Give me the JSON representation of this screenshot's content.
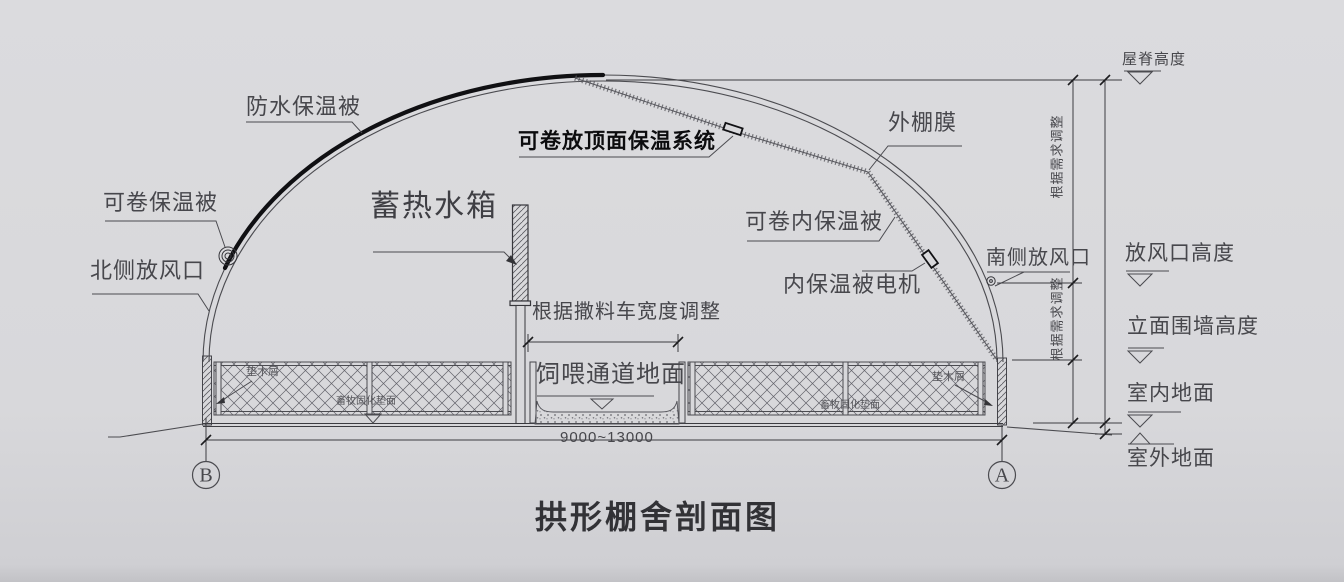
{
  "drawing": {
    "title": "拱形棚舍剖面图",
    "dimension_span": "9000~13000",
    "axis_left": "B",
    "axis_right": "A"
  },
  "callouts": {
    "waterproof_quilt": "防水保温被",
    "rollable_quilt": "可卷保温被",
    "north_vent": "北侧放风口",
    "heat_storage_tank": "蓄热水箱",
    "roof_insulation_system": "可卷放顶面保温系统",
    "outer_film": "外棚膜",
    "rollable_inner_quilt": "可卷内保温被",
    "inner_quilt_motor": "内保温被电机",
    "south_vent": "南侧放风口",
    "adjust_by_feed_truck": "根据撒料车宽度调整",
    "feeding_aisle_ground": "饲喂通道地面",
    "adjust_as_needed": "根据需求调整",
    "bedding_sawdust": "垫木屑",
    "cured_bedding_surface": "畜牧固化垫面"
  },
  "elevations": {
    "ridge_height": "屋脊高度",
    "vent_height": "放风口高度",
    "facade_wall_height": "立面围墙高度",
    "indoor_ground": "室内地面",
    "outdoor_ground": "室外地面"
  },
  "colors": {
    "background": "#d8d8db",
    "line": "#4b4b50",
    "dark_line": "#141416"
  }
}
